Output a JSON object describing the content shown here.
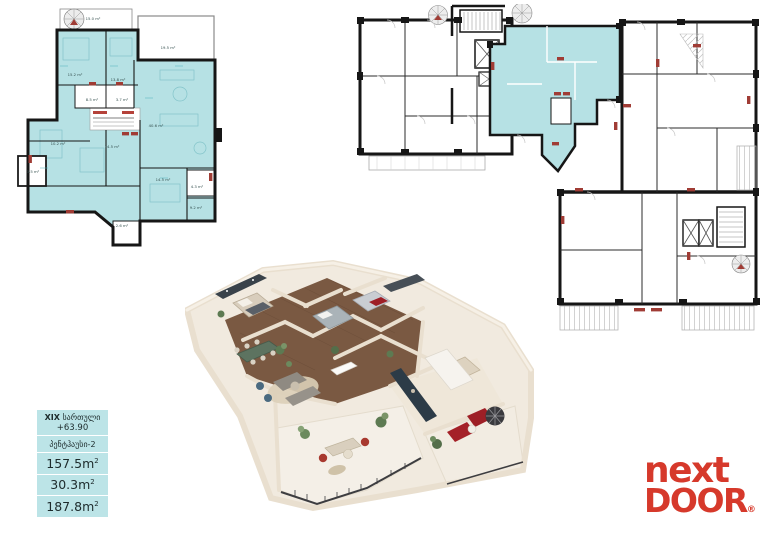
{
  "page": {
    "background": "#ffffff"
  },
  "colors": {
    "highlight_teal": "#b6e1e4",
    "info_box_bg": "#bce4e7",
    "wall_black": "#161616",
    "door_marker_red": "#a03c35",
    "logo_red": "#d6392b"
  },
  "info_box": {
    "floor_numeral": "XIX",
    "floor_word": "სართული",
    "elevation": "+63.90",
    "unit_type": "პენტჰაუსი-2",
    "areas": [
      {
        "name": "inner-area",
        "value": "157.5m",
        "sup": "2"
      },
      {
        "name": "balcony-area",
        "value": "30.3m",
        "sup": "2"
      },
      {
        "name": "total-area",
        "value": "187.8m",
        "sup": "2"
      }
    ]
  },
  "logo": {
    "word_top": "next",
    "word_bottom": "DOOR",
    "registered": "®"
  },
  "plan_small": {
    "description": "detailed 2D plan of penthouse unit, rooms highlighted teal",
    "labels": [
      {
        "text": "15.0 m²",
        "x": 37.4,
        "y": 4.6
      },
      {
        "text": "15.2 m²",
        "x": 29.3,
        "y": 27.9
      },
      {
        "text": "13.8 m²",
        "x": 48.6,
        "y": 30.0
      },
      {
        "text": "19.5 m²",
        "x": 71.2,
        "y": 16.7
      },
      {
        "text": "40.6 m²",
        "x": 65.8,
        "y": 49.2
      },
      {
        "text": "8.5 m²",
        "x": 36.9,
        "y": 38.3
      },
      {
        "text": "3.7 m²",
        "x": 50.5,
        "y": 38.3
      },
      {
        "text": "10.2 m²",
        "x": 21.6,
        "y": 56.7
      },
      {
        "text": "14.5 m²",
        "x": 45.9,
        "y": 57.9
      },
      {
        "text": "3.5 m²",
        "x": 10.4,
        "y": 68.3
      },
      {
        "text": "14.5 m²",
        "x": 68.9,
        "y": 71.7
      },
      {
        "text": "4.3 m²",
        "x": 84.2,
        "y": 74.6
      },
      {
        "text": "9.2 m²",
        "x": 83.8,
        "y": 83.3
      },
      {
        "text": "2.6 m²",
        "x": 50.5,
        "y": 90.8
      }
    ]
  },
  "plan_large": {
    "description": "full floor plan of building, penthouse unit highlighted teal"
  },
  "render_3d": {
    "description": "isometric 3D furnished cutaway of the penthouse apartment"
  }
}
